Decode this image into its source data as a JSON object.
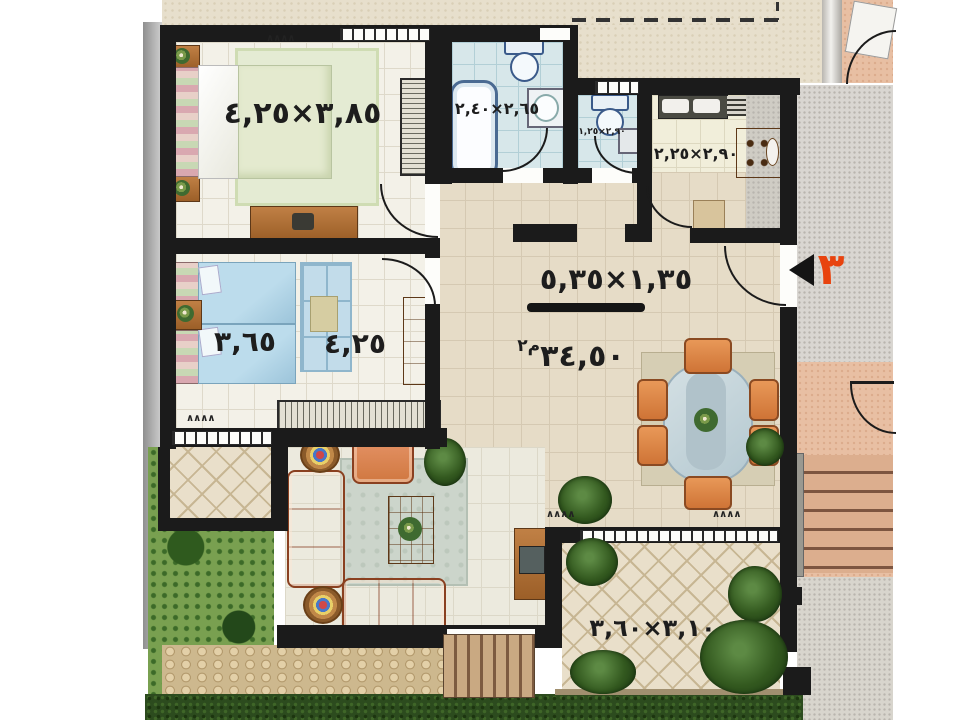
{
  "labels": {
    "bedroom1_dim": "٣,٨٥×٤,٢٥",
    "bedroom2_dim_a": "٣,٦٥",
    "bedroom2_dim_b": "٤,٢٥",
    "bathroom_dim": "٢,٦٥×٢,٤٠",
    "wc_dim": "٢,٩٠×١,٢٥",
    "kitchen_dim": "٢,٩٠×٢,٢٥",
    "hall_dim": "١,٣٥×٥,٣٥",
    "total_area_value": "٣٤,٥٠",
    "total_area_unit": "م٢",
    "terrace_dim": "٣,١٠×٣,٦٠",
    "entrance_number": "٣",
    "vent_mark": "∧∧∧∧"
  },
  "colors": {
    "wall": "#1b1b1b",
    "entrance_number": "#e8430e",
    "sofa": "#dd8458",
    "hall_floor": "#e6dcc7",
    "bathroom_floor": "#d7e7ea",
    "terrace_tile": "#e9dfca",
    "garden": "#79a050",
    "hedge": "#2c4b1e",
    "exterior_salmon": "#e8bfa3"
  }
}
